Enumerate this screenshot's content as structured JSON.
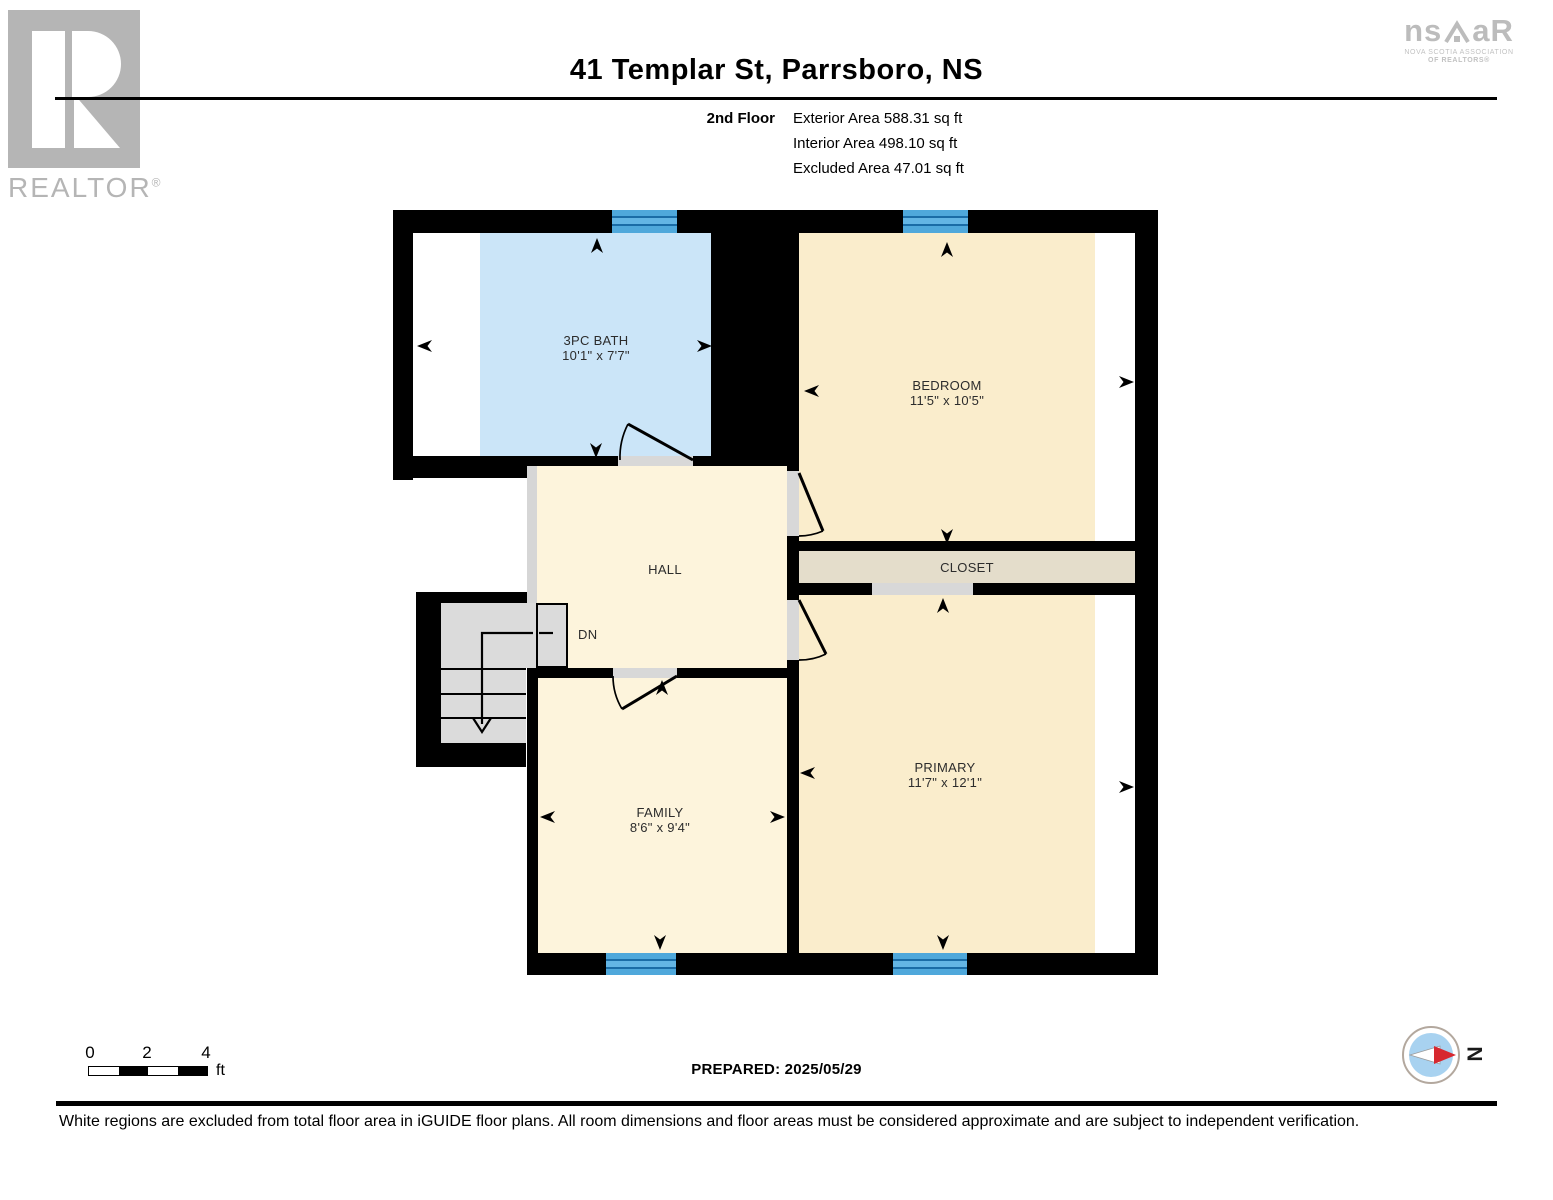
{
  "header": {
    "title": "41 Templar St, Parrsboro, NS",
    "floor_label": "2nd Floor",
    "areas": [
      "Exterior Area 588.31 sq ft",
      "Interior Area 498.10 sq ft",
      "Excluded Area 47.01 sq ft"
    ]
  },
  "logos": {
    "realtor_text": "REALTOR",
    "realtor_reg": "®",
    "nsar_ns": "ns",
    "nsar_ar": "aR",
    "nsar_caption1": "NOVA SCOTIA ASSOCIATION",
    "nsar_caption2": "OF REALTORS®"
  },
  "rooms": {
    "bath": {
      "name": "3PC BATH",
      "dims": "10'1\" x 7'7\""
    },
    "bedroom": {
      "name": "BEDROOM",
      "dims": "11'5\" x 10'5\""
    },
    "closet": {
      "name": "CLOSET"
    },
    "hall": {
      "name": "HALL"
    },
    "stairs": {
      "label": "DN"
    },
    "family": {
      "name": "FAMILY",
      "dims": "8'6\" x 9'4\""
    },
    "primary": {
      "name": "PRIMARY",
      "dims": "11'7\" x 12'1\""
    }
  },
  "scale": {
    "ticks": [
      "0",
      "2",
      "4"
    ],
    "unit": "ft"
  },
  "compass": {
    "north": "N"
  },
  "footer": {
    "prepared": "PREPARED: 2025/05/29",
    "disclaimer": "White regions are excluded from total floor area in iGUIDE floor plans. All room dimensions and floor areas must be considered approximate and are subject to independent verification."
  },
  "colors": {
    "wall": "#000000",
    "bath_fill": "#cbe5f8",
    "hall_family_fill": "#fdf4dc",
    "bedroom_primary_fill": "#faedcc",
    "closet_fill": "#e4ddcb",
    "excluded_fill": "#ffffff",
    "window_blue": "#4fa8db",
    "stair_gray": "#dbdbdb",
    "door_sill_gray": "#d8d8d8",
    "compass_red": "#d7282f",
    "compass_blue": "#a8d2f0",
    "logo_gray": "#b5b5b5"
  }
}
